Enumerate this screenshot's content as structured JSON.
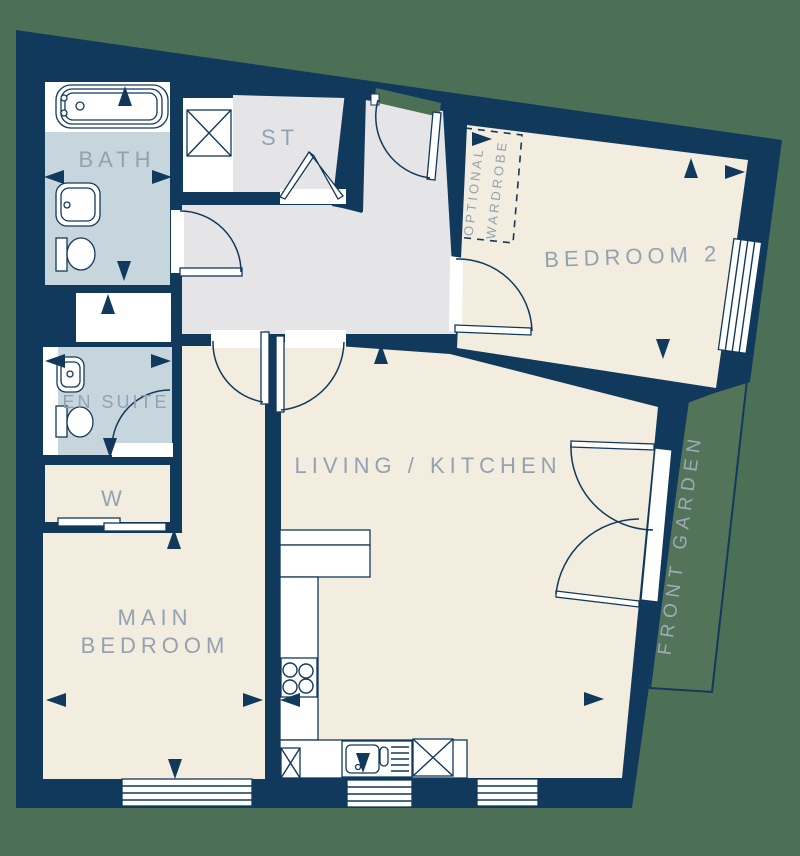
{
  "labels": {
    "bath": "BATH",
    "storage": "ST",
    "bedroom2": "BEDROOM 2",
    "optional_wardrobe_line1": "OPTIONAL",
    "optional_wardrobe_line2": "WARDROBE",
    "en_suite": "EN SUITE",
    "wardrobe": "W",
    "main_bedroom_line1": "MAIN",
    "main_bedroom_line2": "BEDROOM",
    "living_kitchen": "LIVING / KITCHEN",
    "front_garden": "FRONT GARDEN"
  },
  "colors": {
    "background_green": "#4c7055",
    "garden_green": "#547459",
    "wall_navy": "#11395c",
    "floor_beige": "#f2edde",
    "floor_gray": "#e5e4e6",
    "floor_blue": "#c7d6dc",
    "fixture_white": "#ffffff",
    "label_gray": "#93a2b1",
    "garden_label_gray": "#9dabb8"
  },
  "icons": {
    "fixtures": [
      "bathtub",
      "washbasin",
      "toilet",
      "shower-tray",
      "storage-cupboard",
      "bifold-door",
      "hinged-door",
      "sliding-door",
      "french-doors",
      "kitchen-hob",
      "kitchen-sink",
      "appliance-space",
      "window",
      "dimension-arrow"
    ],
    "dimension_arrows": [
      {
        "name": "bath-top",
        "dir": "up",
        "x": 125,
        "y": 86
      },
      {
        "name": "bath-left",
        "dir": "left",
        "x": 44,
        "y": 177
      },
      {
        "name": "bath-right",
        "dir": "right",
        "x": 172,
        "y": 177
      },
      {
        "name": "bath-bottom",
        "dir": "down",
        "x": 124,
        "y": 281
      },
      {
        "name": "shower",
        "dir": "up",
        "x": 108,
        "y": 294
      },
      {
        "name": "ensuite-left",
        "dir": "left",
        "x": 45,
        "y": 361
      },
      {
        "name": "ensuite-right",
        "dir": "right",
        "x": 171,
        "y": 361
      },
      {
        "name": "ensuite-bottom",
        "dir": "down",
        "x": 110,
        "y": 458
      },
      {
        "name": "wardrobe-bottom",
        "dir": "up",
        "x": 174,
        "y": 529
      },
      {
        "name": "main-bedroom-left",
        "dir": "left",
        "x": 46,
        "y": 700
      },
      {
        "name": "main-bedroom-right",
        "dir": "right",
        "x": 263,
        "y": 700
      },
      {
        "name": "main-bedroom-bottom",
        "dir": "down",
        "x": 175,
        "y": 779
      },
      {
        "name": "living-top",
        "dir": "up",
        "x": 381,
        "y": 344
      },
      {
        "name": "kitchen-hob",
        "dir": "left",
        "x": 280,
        "y": 700
      },
      {
        "name": "living-right",
        "dir": "right",
        "x": 604,
        "y": 699
      },
      {
        "name": "kitchen-sink",
        "dir": "down",
        "x": 363,
        "y": 773
      },
      {
        "name": "wardrobe-optional",
        "dir": "right",
        "x": 492,
        "y": 139
      },
      {
        "name": "bedroom2-top",
        "dir": "up",
        "x": 691,
        "y": 158
      },
      {
        "name": "bedroom2-right",
        "dir": "right",
        "x": 745,
        "y": 172
      },
      {
        "name": "bedroom2-bottom",
        "dir": "down",
        "x": 663,
        "y": 359
      }
    ]
  }
}
